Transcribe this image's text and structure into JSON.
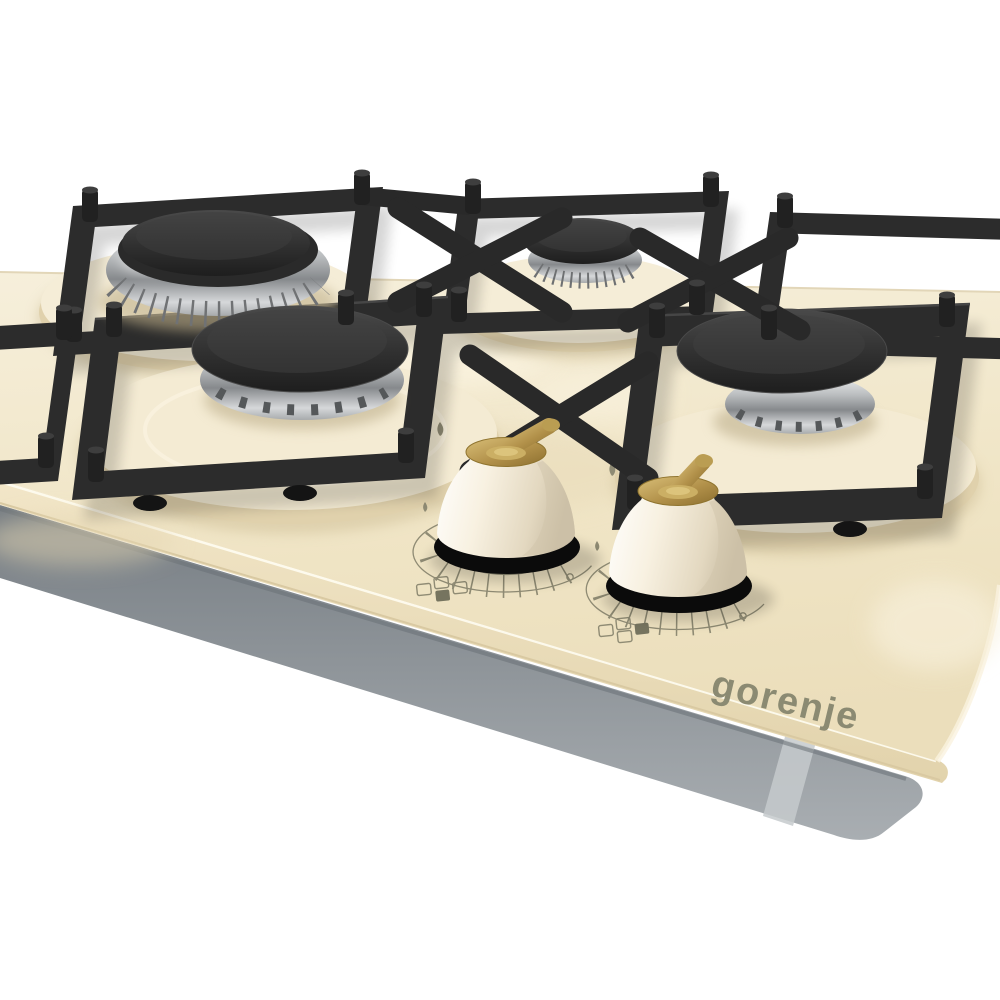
{
  "image_type": "product-photo",
  "subject": "built-in gas hob on cream tempered glass, three-quarter perspective view on white background",
  "brand": {
    "logo_text": "gorenje",
    "logo_color": "#8b8a72"
  },
  "appliance": {
    "glass_color_name": "ivory cream",
    "visible_burners": [
      {
        "position": "back-left",
        "type": "large wok burner",
        "parts": "chrome crown ring, black cap"
      },
      {
        "position": "front-left",
        "type": "large burner",
        "parts": "chrome ring with flame slots, black cap"
      },
      {
        "position": "back-center",
        "type": "auxiliary small burner",
        "parts": "chrome ribbed ring, black cap"
      },
      {
        "position": "right",
        "type": "standard burner",
        "parts": "chrome ring with flame slots, black cap"
      }
    ],
    "pan_supports": "black cast-iron square frames with corner prongs",
    "base": "stainless steel tray under glass",
    "knobs": [
      {
        "style": "cream bell knob, brass cap and handle, black base ring",
        "dial": "printed fan scale with flame symbols and off dot",
        "burner_selector_icon": "four-square icon, front square filled"
      },
      {
        "style": "cream bell knob, brass cap and handle, black base ring",
        "dial": "printed fan scale with flame symbols and off dot",
        "burner_selector_icon": "four-square icon, right square filled"
      }
    ]
  },
  "palette": {
    "background": "#ffffff",
    "glass_cream": "#f0e5c6",
    "glass_shadow": "#e0d1ac",
    "cast_iron": "#2c2c2c",
    "chrome_light": "#f2f3f4",
    "chrome_dark": "#86898c",
    "burner_cap": "#2e2e2e",
    "brass": "#b2914a",
    "knob_cream": "#f8f1e1",
    "steel_base": "#8d9398",
    "print_olive": "#8f8b74"
  }
}
